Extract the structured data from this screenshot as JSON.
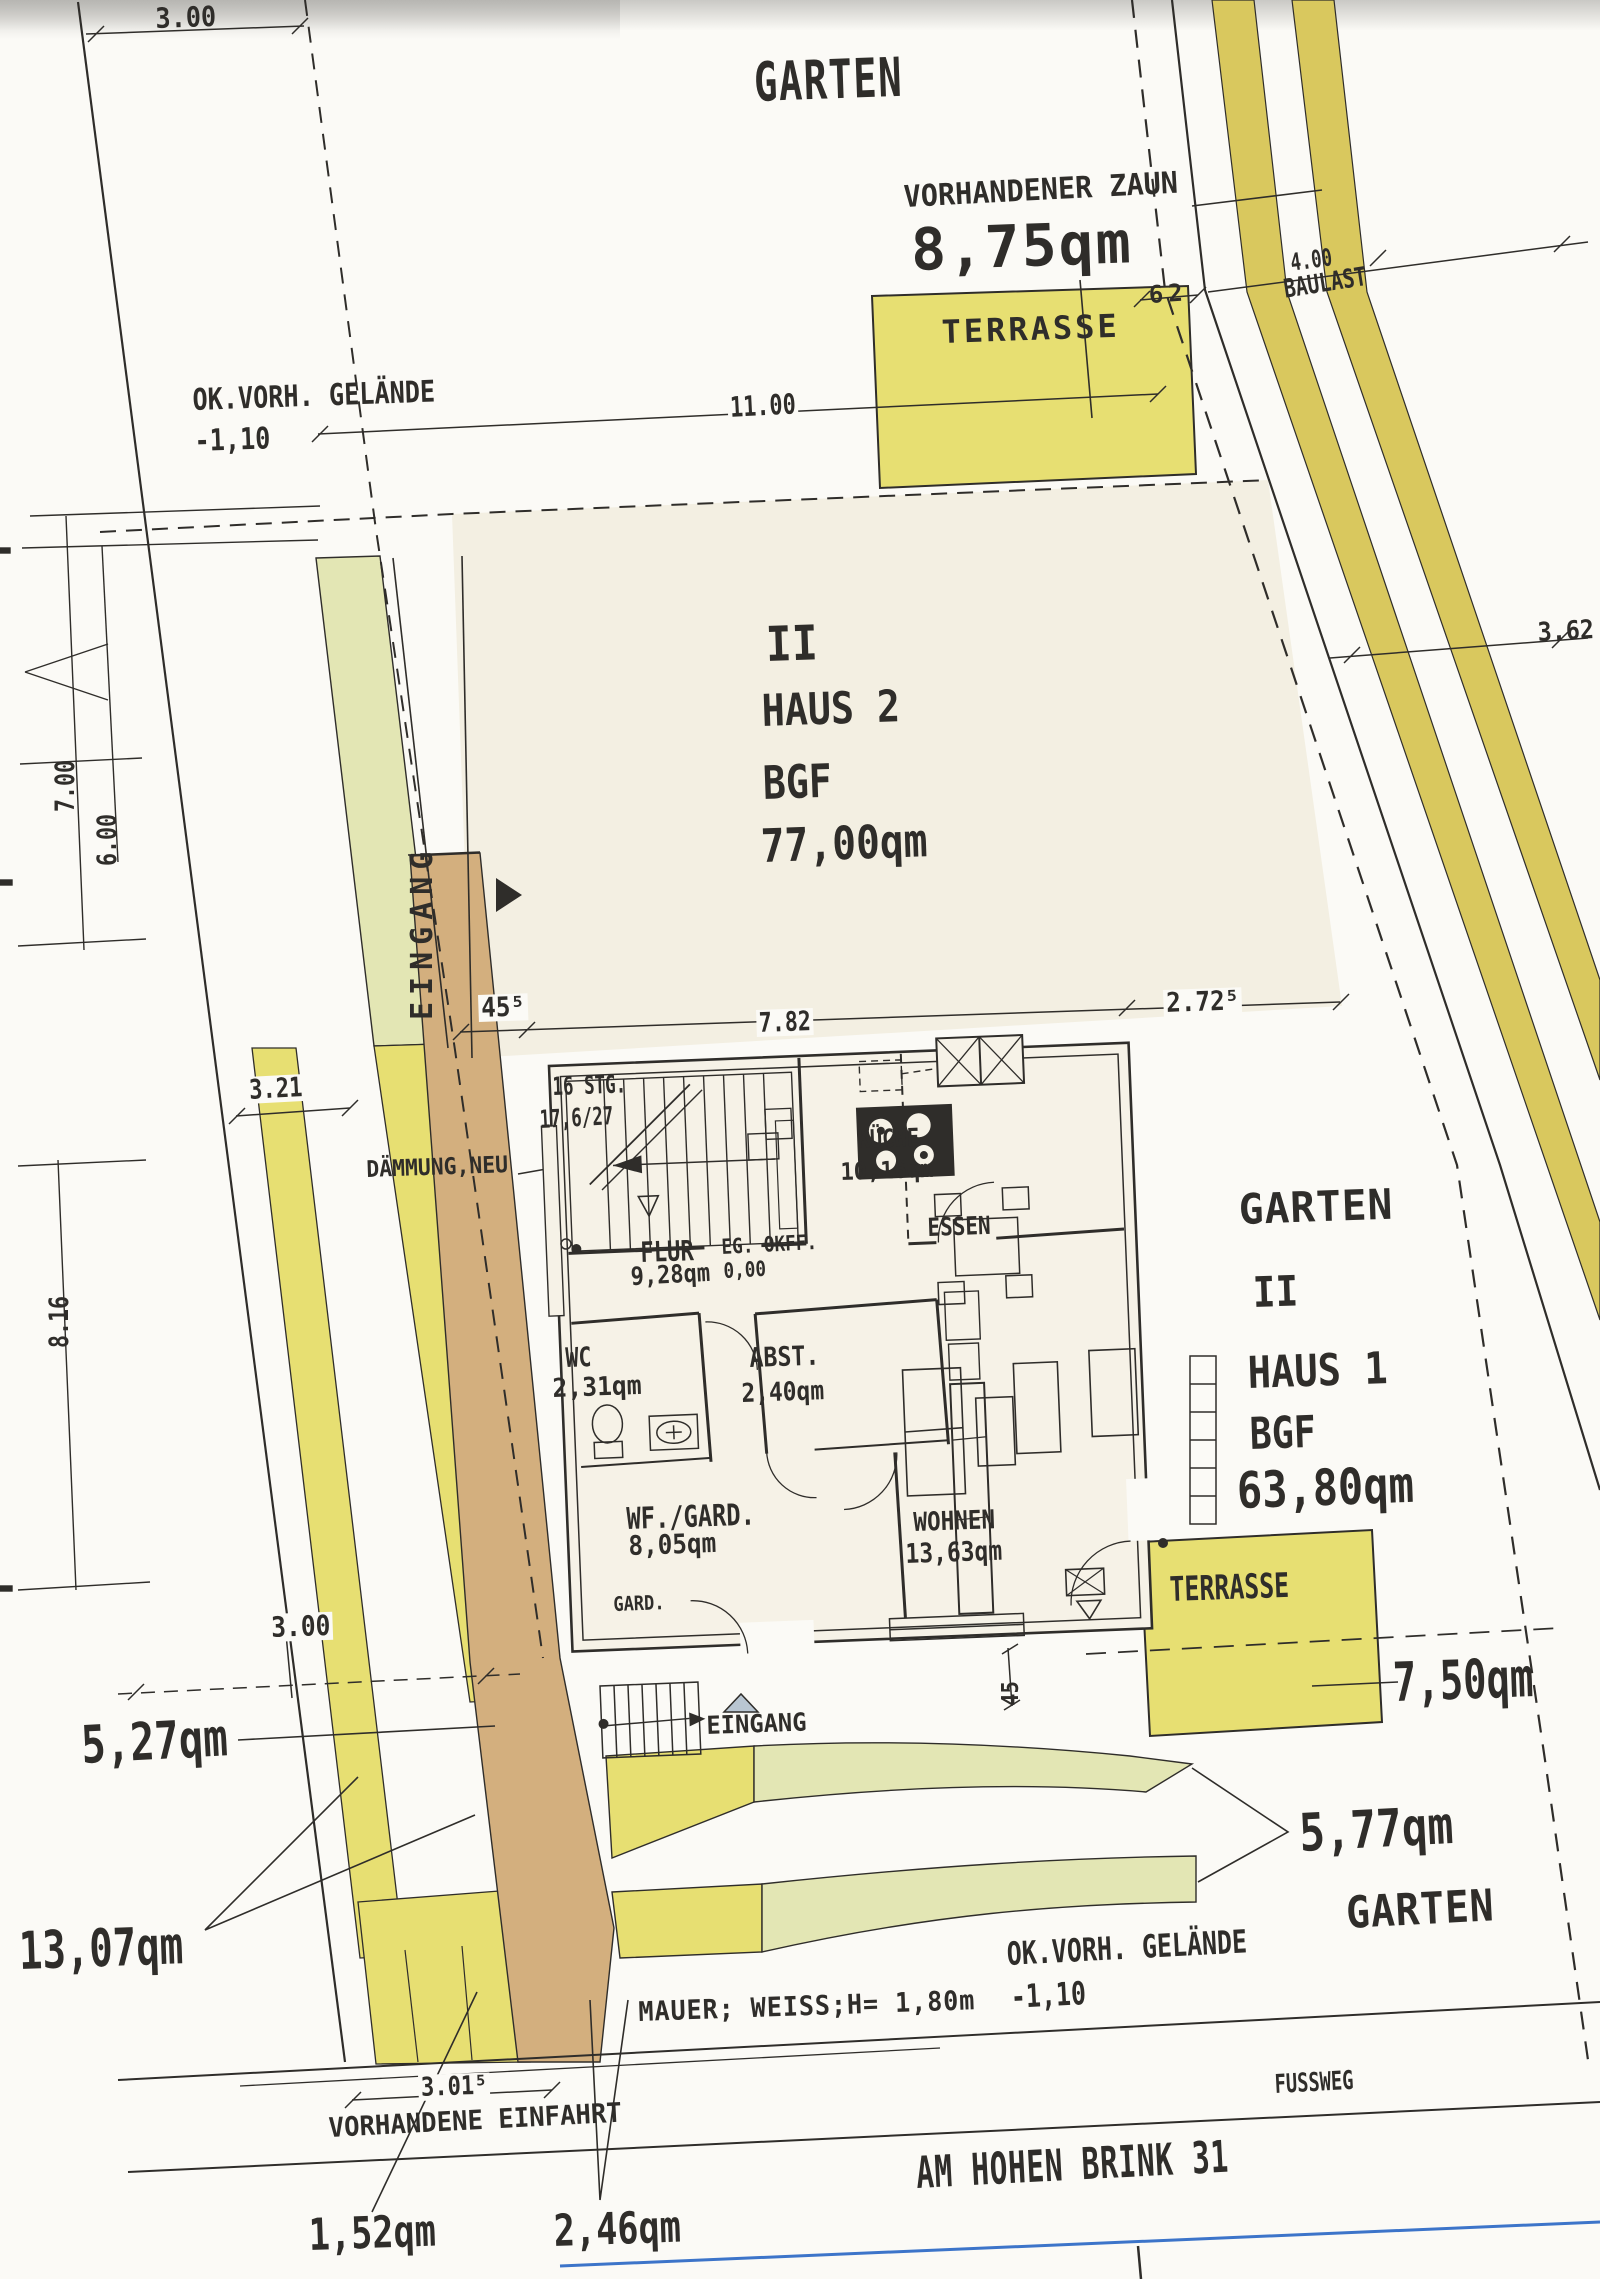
{
  "document_type": "site-plan-scan",
  "palette": {
    "paper": "#fbfaf6",
    "ink": "#2f2d2a",
    "cream": "#f3efe2",
    "cream2": "#f6f2e7",
    "yellow": "#e7df72",
    "olive": "#d9c85e",
    "palegreen": "#e3e6b4",
    "tan": "#d3af7e",
    "blue": "#3c74c9",
    "graytri": "#b9c6d2"
  },
  "labels": [
    {
      "name": "dim-3-00-top",
      "text": "3.00",
      "x": 155,
      "y": 5,
      "s": 28,
      "sx": 0.9,
      "r": -2
    },
    {
      "name": "garten-top",
      "text": "GARTEN",
      "x": 753,
      "y": 56,
      "s": 54,
      "sx": 0.72,
      "ls": 2,
      "r": -2
    },
    {
      "name": "vorhandener-zaun",
      "text": "VORHANDENER ZAUN",
      "x": 903,
      "y": 183,
      "s": 30,
      "sx": 0.95,
      "r": -3
    },
    {
      "name": "zaun-area",
      "text": "8,75qm",
      "x": 910,
      "y": 221,
      "s": 58,
      "ls": 2,
      "r": -2
    },
    {
      "name": "terrasse-top-label",
      "text": "TERRASSE",
      "x": 941,
      "y": 316,
      "s": 32,
      "ls": 3,
      "r": -2
    },
    {
      "name": "dim-62",
      "text": "62",
      "x": 1148,
      "y": 283,
      "s": 24,
      "ls": 5,
      "r": -4
    },
    {
      "name": "dim-4-00",
      "text": "4.00",
      "x": 1289,
      "y": 251,
      "s": 24,
      "sx": 0.72,
      "r": -8
    },
    {
      "name": "baulast",
      "text": "BAULAST",
      "x": 1282,
      "y": 277,
      "s": 26,
      "sx": 0.76,
      "r": -9
    },
    {
      "name": "ok-vorh-gelaende-top",
      "text": "OK.VORH. GELÄNDE",
      "x": 192,
      "y": 386,
      "s": 30,
      "sx": 0.84,
      "r": -2
    },
    {
      "name": "minus-1-10-top",
      "text": "-1,10",
      "x": 194,
      "y": 427,
      "s": 30,
      "sx": 0.84,
      "r": -2
    },
    {
      "name": "dim-11-00",
      "text": "11.00",
      "x": 727,
      "y": 394,
      "s": 28,
      "sx": 0.78,
      "r": -3,
      "bg": 1
    },
    {
      "name": "haus2-ii",
      "text": "II",
      "x": 765,
      "y": 621,
      "s": 48,
      "sx": 0.9,
      "r": -2
    },
    {
      "name": "haus2-name",
      "text": "HAUS 2",
      "x": 761,
      "y": 690,
      "s": 44,
      "sx": 0.87,
      "r": -2
    },
    {
      "name": "haus2-bgf",
      "text": "BGF",
      "x": 762,
      "y": 760,
      "s": 46,
      "sx": 0.83,
      "r": -2
    },
    {
      "name": "haus2-area",
      "text": "77,00qm",
      "x": 760,
      "y": 823,
      "s": 46,
      "sx": 0.86,
      "r": -2
    },
    {
      "name": "eingang-left",
      "text": "EINGANG",
      "x": 408,
      "y": 1020,
      "s": 30,
      "ls": 7,
      "v": 1
    },
    {
      "name": "dim-45-5",
      "text": "45⁵",
      "x": 478,
      "y": 995,
      "s": 27,
      "sx": 0.9,
      "r": -2,
      "bg": 1
    },
    {
      "name": "dim-7-82",
      "text": "7.82",
      "x": 756,
      "y": 1010,
      "s": 27,
      "sx": 0.8,
      "r": -2,
      "bg": 1
    },
    {
      "name": "dim-2-72-5",
      "text": "2.72⁵",
      "x": 1163,
      "y": 990,
      "s": 27,
      "sx": 0.9,
      "r": -2,
      "bg": 1
    },
    {
      "name": "dim-3-21",
      "text": "3.21",
      "x": 246,
      "y": 1077,
      "s": 27,
      "sx": 0.82,
      "r": -3,
      "bg": 1
    },
    {
      "name": "daemmung-neu",
      "text": "DÄMMUNG,NEU",
      "x": 366,
      "y": 1159,
      "s": 23,
      "sx": 0.93,
      "r": -2
    },
    {
      "name": "stairs-16-stg",
      "text": "16 STG.",
      "x": 552,
      "y": 1074,
      "s": 25,
      "sx": 0.7,
      "r": -2
    },
    {
      "name": "stairs-17-6-27",
      "text": "17,6/27",
      "x": 539,
      "y": 1107,
      "s": 25,
      "sx": 0.7,
      "r": -3
    },
    {
      "name": "kueche",
      "text": "KÜCHE",
      "x": 857,
      "y": 1127,
      "s": 25,
      "sx": 0.82,
      "r": -2
    },
    {
      "name": "kueche-area",
      "text": "10,16qm",
      "x": 840,
      "y": 1160,
      "s": 24,
      "sx": 0.92,
      "r": -2
    },
    {
      "name": "essen",
      "text": "ESSEN",
      "x": 927,
      "y": 1215,
      "s": 25,
      "sx": 0.84,
      "r": -2
    },
    {
      "name": "flur",
      "text": "FLUR",
      "x": 640,
      "y": 1239,
      "s": 28,
      "sx": 0.79,
      "r": -2
    },
    {
      "name": "flur-area",
      "text": "9,28qm",
      "x": 630,
      "y": 1264,
      "s": 25,
      "sx": 0.88,
      "r": -3
    },
    {
      "name": "eg-okff",
      "text": "EG. OKFF.",
      "x": 721,
      "y": 1237,
      "s": 21,
      "sx": 0.84,
      "r": -3
    },
    {
      "name": "eg-okff-val",
      "text": "0,00",
      "x": 723,
      "y": 1261,
      "s": 21,
      "sx": 0.84,
      "r": -3
    },
    {
      "name": "wc",
      "text": "WC",
      "x": 565,
      "y": 1345,
      "s": 27,
      "sx": 0.8,
      "r": -2
    },
    {
      "name": "wc-area",
      "text": "2,31qm",
      "x": 552,
      "y": 1376,
      "s": 26,
      "sx": 0.95,
      "r": -2
    },
    {
      "name": "abst",
      "text": "ABST.",
      "x": 749,
      "y": 1345,
      "s": 27,
      "sx": 0.86,
      "r": -2
    },
    {
      "name": "abst-area",
      "text": "2,40qm",
      "x": 741,
      "y": 1381,
      "s": 26,
      "sx": 0.88,
      "r": -2
    },
    {
      "name": "wf-gard",
      "text": "WF./GARD.",
      "x": 626,
      "y": 1505,
      "s": 30,
      "sx": 0.79,
      "r": -2
    },
    {
      "name": "wf-gard-area",
      "text": "8,05qm",
      "x": 628,
      "y": 1533,
      "s": 27,
      "sx": 0.9,
      "r": -2
    },
    {
      "name": "gard",
      "text": "GARD.",
      "x": 613,
      "y": 1594,
      "s": 20,
      "sx": 0.85,
      "r": -2
    },
    {
      "name": "wohnen",
      "text": "WOHNEN",
      "x": 913,
      "y": 1510,
      "s": 26,
      "sx": 0.87,
      "r": -2
    },
    {
      "name": "wohnen-area",
      "text": "13,63qm",
      "x": 905,
      "y": 1541,
      "s": 27,
      "sx": 0.85,
      "r": -2
    },
    {
      "name": "garten-right",
      "text": "GARTEN",
      "x": 1238,
      "y": 1189,
      "s": 42,
      "sx": 0.98,
      "ls": 1,
      "r": -2
    },
    {
      "name": "haus1-ii",
      "text": "II",
      "x": 1252,
      "y": 1272,
      "s": 42,
      "sx": 0.9,
      "r": -2
    },
    {
      "name": "haus1-name",
      "text": "HAUS 1",
      "x": 1247,
      "y": 1352,
      "s": 44,
      "sx": 0.88,
      "r": -2
    },
    {
      "name": "haus1-bgf",
      "text": "BGF",
      "x": 1249,
      "y": 1413,
      "s": 44,
      "sx": 0.83,
      "r": -2
    },
    {
      "name": "haus1-area",
      "text": "63,80qm",
      "x": 1236,
      "y": 1466,
      "s": 50,
      "sx": 0.84,
      "r": -2
    },
    {
      "name": "terrasse-right-label",
      "text": "TERRASSE",
      "x": 1169,
      "y": 1573,
      "s": 34,
      "sx": 0.73,
      "r": -2
    },
    {
      "name": "terrasse-right-area",
      "text": "7,50qm",
      "x": 1392,
      "y": 1656,
      "s": 54,
      "sx": 0.72,
      "r": -2
    },
    {
      "name": "area-5-27",
      "text": "5,27qm",
      "x": 80,
      "y": 1720,
      "s": 52,
      "sx": 0.78,
      "r": -3
    },
    {
      "name": "area-13-07",
      "text": "13,07qm",
      "x": 18,
      "y": 1926,
      "s": 52,
      "sx": 0.75,
      "r": -2
    },
    {
      "name": "eingang-bottom",
      "text": "EINGANG",
      "x": 706,
      "y": 1713,
      "s": 25,
      "sx": 0.95,
      "r": -2
    },
    {
      "name": "dim-3-00-left",
      "text": "3.00",
      "x": 268,
      "y": 1614,
      "s": 28,
      "sx": 0.88,
      "r": -2,
      "bg": 1
    },
    {
      "name": "area-5-77",
      "text": "5,77qm",
      "x": 1298,
      "y": 1808,
      "s": 52,
      "sx": 0.82,
      "r": -3
    },
    {
      "name": "garten-bottom",
      "text": "GARTEN",
      "x": 1345,
      "y": 1892,
      "s": 44,
      "sx": 0.9,
      "ls": 1,
      "r": -3
    },
    {
      "name": "ok-vorh-gelaende-bottom",
      "text": "OK.VORH. GELÄNDE",
      "x": 1006,
      "y": 1938,
      "s": 32,
      "sx": 0.78,
      "r": -3
    },
    {
      "name": "minus-1-10-bottom",
      "text": "-1,10",
      "x": 1010,
      "y": 1981,
      "s": 32,
      "sx": 0.78,
      "r": -3
    },
    {
      "name": "mauer-weiss",
      "text": "MAUER; WEISS;H= 1,80m",
      "x": 638,
      "y": 1999,
      "s": 27,
      "sx": 0.93,
      "ls": 1,
      "r": -2
    },
    {
      "name": "dim-3-01-5",
      "text": "3.01⁵",
      "x": 418,
      "y": 2075,
      "s": 26,
      "sx": 0.85,
      "r": -2,
      "bg": 1
    },
    {
      "name": "vorhandene-einfahrt",
      "text": "VORHANDENE EINFAHRT",
      "x": 328,
      "y": 2115,
      "s": 27,
      "sx": 0.95,
      "r": -3
    },
    {
      "name": "fussweg",
      "text": "FUSSWEG",
      "x": 1274,
      "y": 2072,
      "s": 26,
      "sx": 0.72,
      "r": -3
    },
    {
      "name": "street-name",
      "text": "AM HOHEN BRINK 31",
      "x": 915,
      "y": 2152,
      "s": 44,
      "sx": 0.67,
      "ls": 1,
      "r": -3
    },
    {
      "name": "area-1-52",
      "text": "1,52qm",
      "x": 308,
      "y": 2214,
      "s": 44,
      "sx": 0.8,
      "r": -2
    },
    {
      "name": "area-2-46",
      "text": "2,46qm",
      "x": 553,
      "y": 2210,
      "s": 44,
      "sx": 0.8,
      "r": -2
    },
    {
      "name": "dim-7-00",
      "text": "7.00",
      "x": 52,
      "y": 812,
      "s": 27,
      "sx": 0.8,
      "v": 1
    },
    {
      "name": "dim-6-00",
      "text": "6.00",
      "x": 94,
      "y": 866,
      "s": 27,
      "sx": 0.8,
      "v": 1
    },
    {
      "name": "dim-8-16",
      "text": "8.16",
      "x": 46,
      "y": 1348,
      "s": 27,
      "sx": 0.8,
      "v": 1
    },
    {
      "name": "dim-3-62",
      "text": "3.62",
      "x": 1537,
      "y": 620,
      "s": 26,
      "sx": 0.9,
      "r": -3
    },
    {
      "name": "dim-45-right",
      "text": "45",
      "x": 1000,
      "y": 1706,
      "s": 23,
      "sx": 0.9,
      "v": 1
    }
  ]
}
